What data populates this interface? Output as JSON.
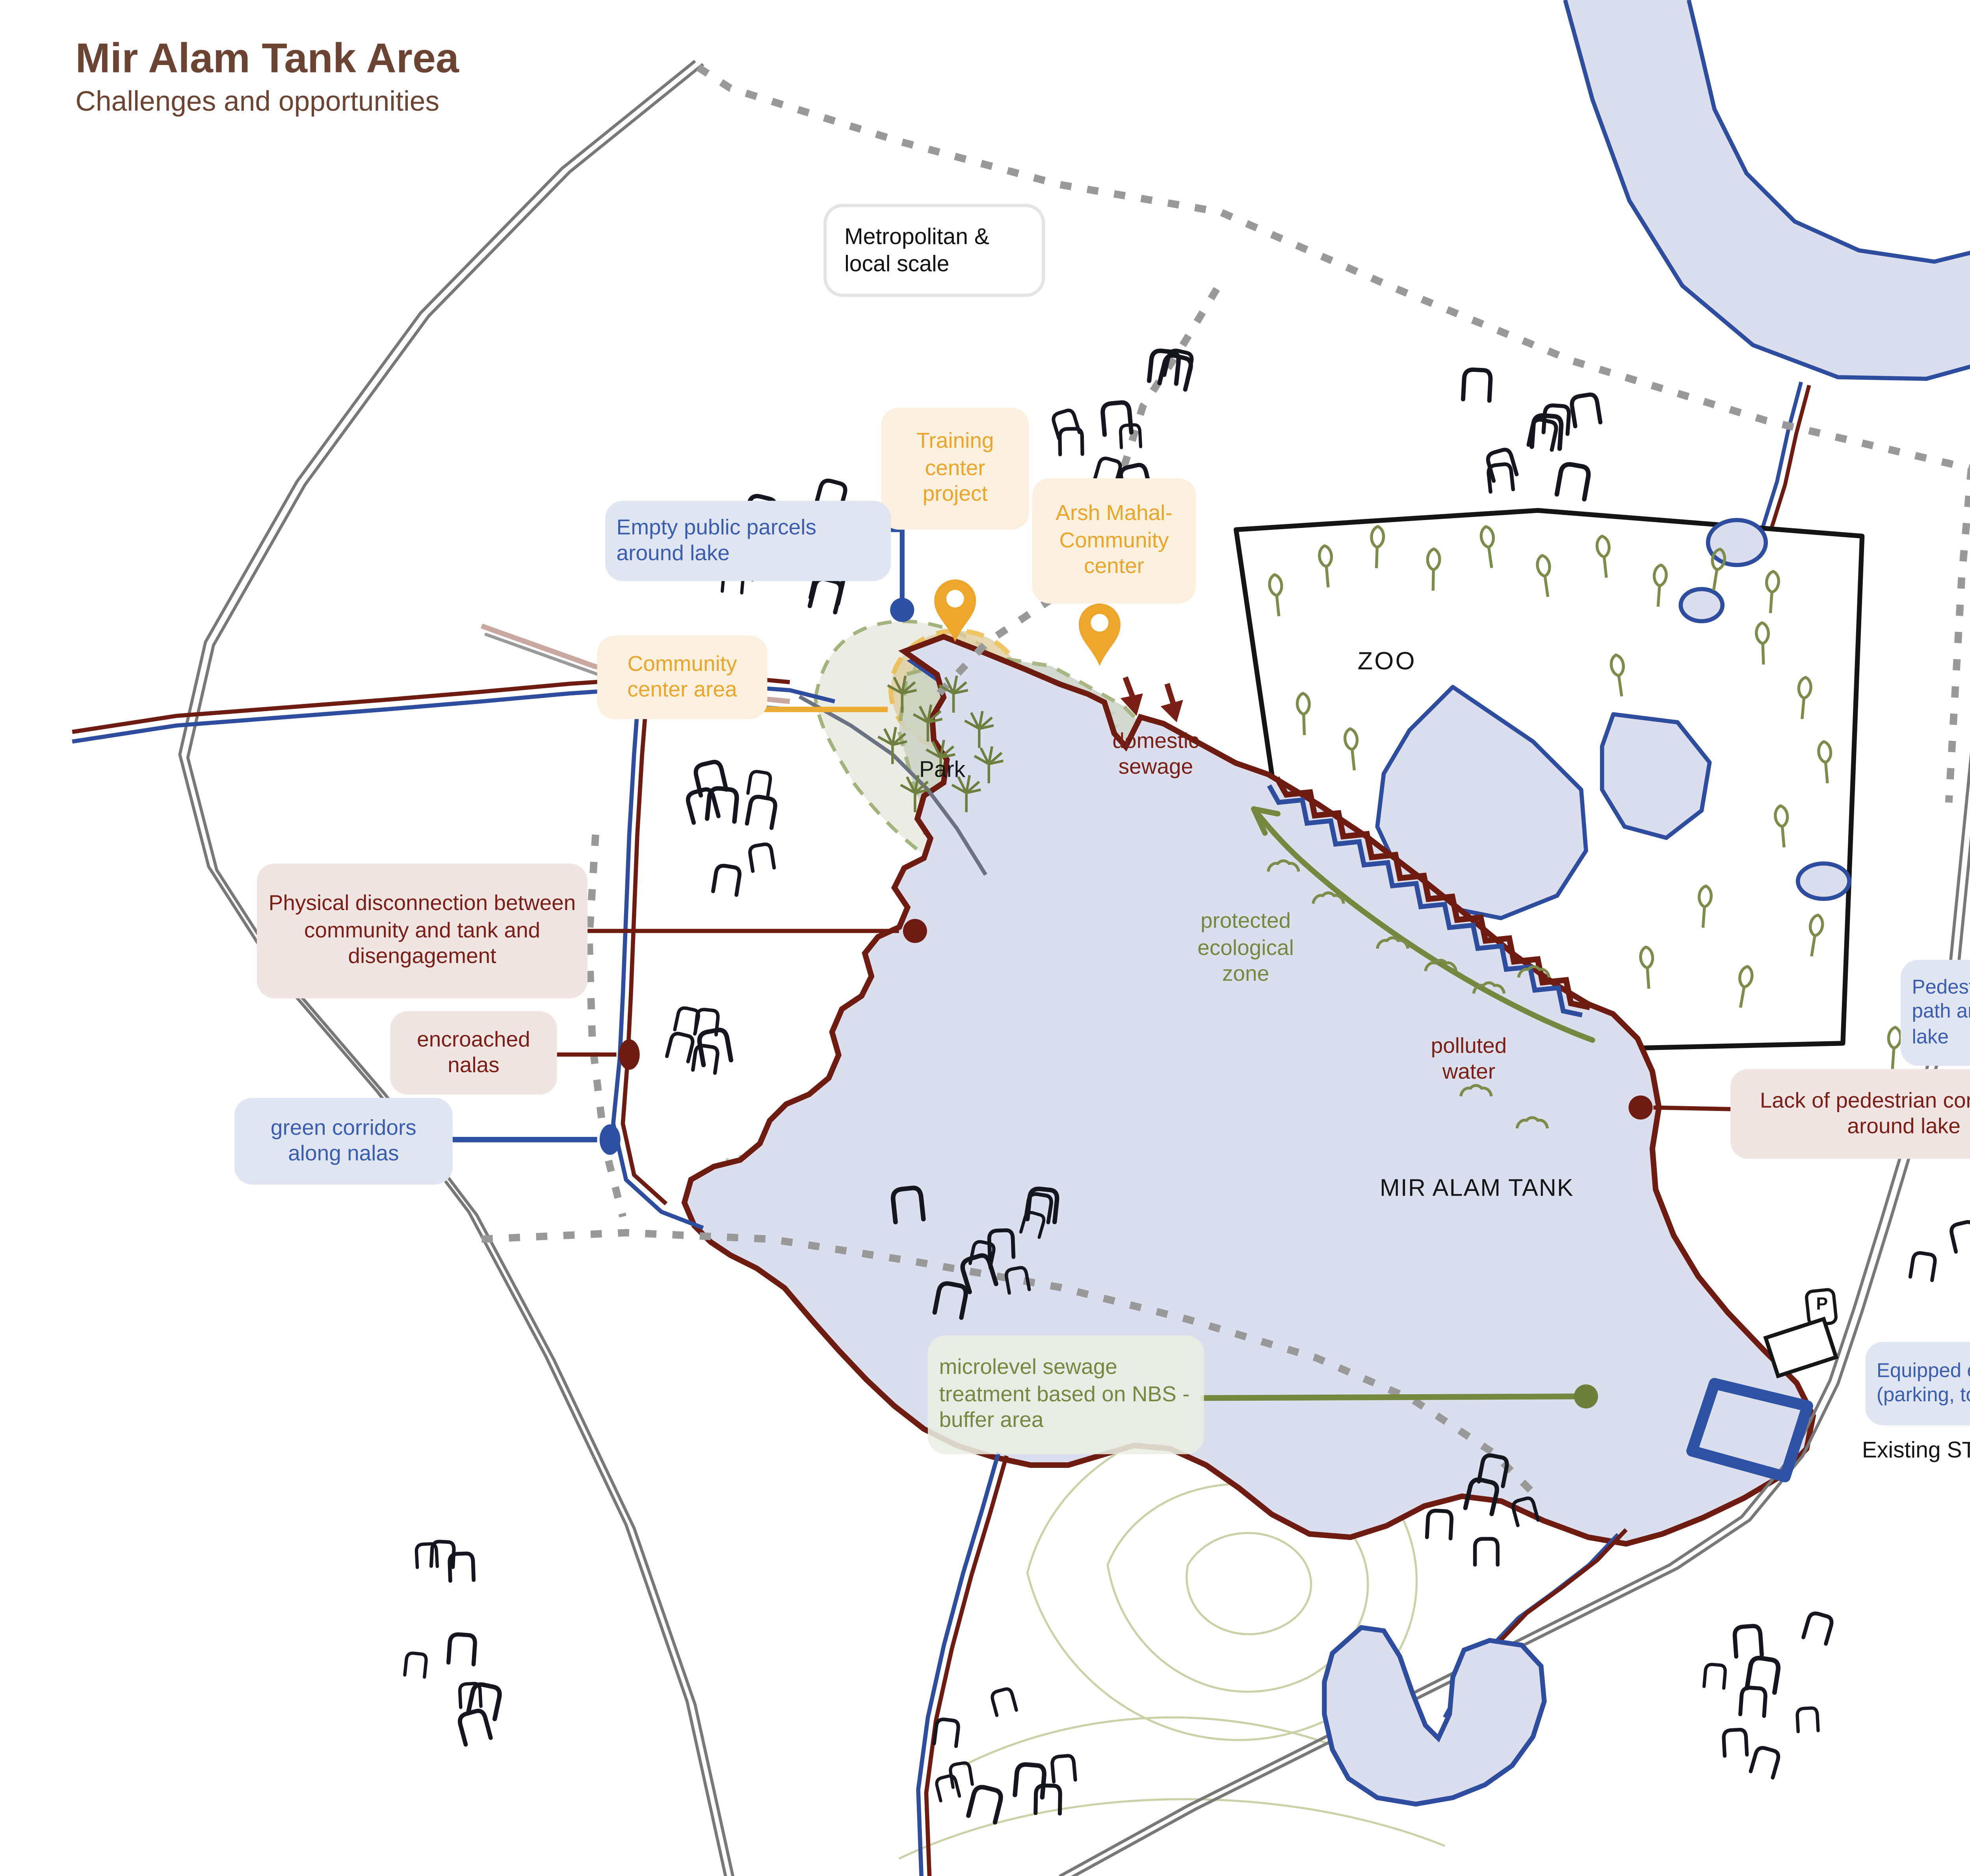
{
  "title": "Mir Alam Tank Area",
  "subtitle": "Challenges and opportunities",
  "scale_note": "Metropolitan & local scale",
  "map_labels": {
    "park": "Park",
    "zoo": "ZOO",
    "lake": "MIR ALAM TANK",
    "stp": "Existing STP",
    "parking_icon": "P"
  },
  "annotations": {
    "training_center": "Training center project",
    "arsh_mahal": "Arsh Mahal- Community center",
    "empty_parcels": "Empty public parcels around lake",
    "community_center_area": "Community center area",
    "domestic_sewage": "domestic sewage",
    "physical_disconnection": "Physical disconnection between community and tank and disengagement",
    "encroached_nalas": "encroached nalas",
    "green_corridors": "green corridors along nalas",
    "protected_zone": "protected ecological zone",
    "polluted_water": "polluted water",
    "pedestrian_path": "Pedestrian path around lake",
    "lack_pedestrian": "Lack of pedestrian connection around lake",
    "microlevel_sewage": "microlevel sewage treatment based on NBS - buffer area",
    "equipped_entry": "Equipped entry point (parking, toilets)"
  },
  "legend": {
    "items": [
      {
        "label": "challenges",
        "color": "#6b4a38",
        "style": "solid"
      },
      {
        "label": "urban opportunites",
        "color": "#2e53a5",
        "style": "solid"
      },
      {
        "label": "ecological opportunities",
        "color": "#9aab70",
        "style": "solid"
      },
      {
        "label": "community opportunities",
        "color": "#ecab32",
        "style": "solid"
      },
      {
        "label": "proposed connections",
        "color": "#9a9a9a",
        "style": "dotted"
      }
    ]
  },
  "colors": {
    "challenges_line": "#6e1b12",
    "urban_line": "#2e53a5",
    "ecological_line": "#9aab70",
    "community_line": "#ecab32",
    "proposed_line": "#9a9a9a",
    "lake_fill": "#dbdfed",
    "title_brown": "#6b4434"
  }
}
